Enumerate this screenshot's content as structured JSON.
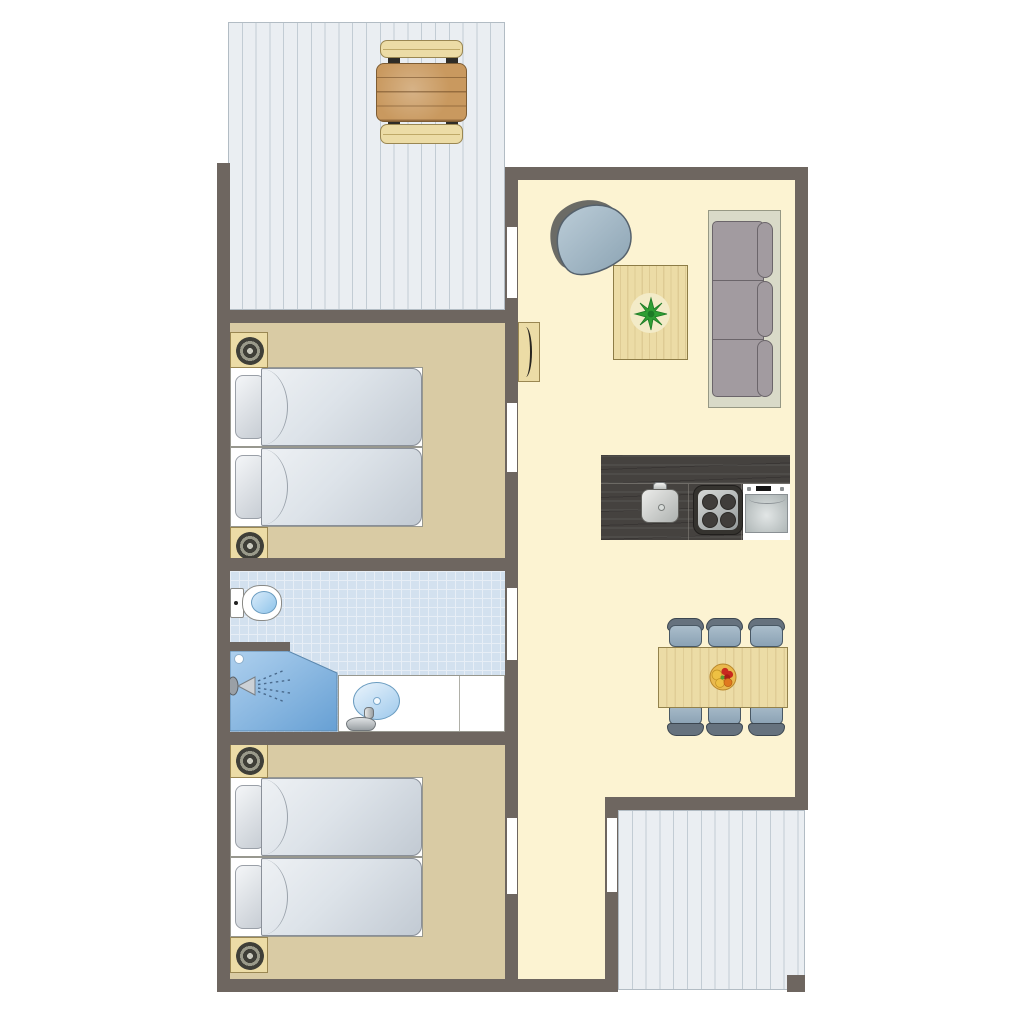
{
  "title": "holiday-cottage-floor-plan",
  "palette": {
    "wall": "#6e6660",
    "living_floor": "#fcf3d2",
    "bedroom_floor": "#d9cba4",
    "bathroom_floor": "#d3e1ef",
    "bathroom_grid": "#e7eef6",
    "deck": "#eaeef2",
    "deck_line": "#c2ccd4",
    "wood_light": "#ecdca6",
    "wood_border": "#9a8752",
    "wood_table": "#c9995f",
    "counter": "#45423f",
    "bed_duvet_light": "#eef1f4",
    "bed_duvet_dark": "#c2cad3",
    "sofa_frame": "#d9dac8",
    "sofa_cushion": "#a29ba0",
    "chair_seat": "#8ba2b4",
    "chair_back": "#66727e",
    "egg_chair": "#a7bac7",
    "shower_light": "#a9cdec",
    "shower_dark": "#6ea6d8",
    "sink_blue": "#9ec9ec",
    "plant": "#2f9e34",
    "fruit_red": "#c8291f",
    "fruit_yellow": "#eec043",
    "fruit_orange": "#e0791f",
    "lamp_dark": "#3f3f38",
    "lamp_ring": "#9a9a8a"
  },
  "areas": [
    {
      "id": "terrace-top",
      "furniture": [
        "picnic-bench",
        "picnic-table",
        "picnic-bench"
      ]
    },
    {
      "id": "bedroom-1",
      "furniture": [
        "nightstand-with-lamp",
        "single-bed",
        "single-bed",
        "nightstand-with-lamp"
      ]
    },
    {
      "id": "bathroom",
      "furniture": [
        "toilet",
        "shower",
        "washbasin-vanity"
      ]
    },
    {
      "id": "bedroom-2",
      "furniture": [
        "nightstand-with-lamp",
        "single-bed",
        "single-bed",
        "nightstand-with-lamp"
      ]
    },
    {
      "id": "living-room",
      "furniture": [
        "lounge-chair",
        "wall-tv",
        "coffee-table-with-plant",
        "three-seat-sofa"
      ]
    },
    {
      "id": "kitchen",
      "furniture": [
        "kitchen-sink",
        "hob-4-burners",
        "dishwasher"
      ]
    },
    {
      "id": "dining-corner",
      "furniture": [
        "dining-table",
        "chair",
        "chair",
        "chair",
        "chair",
        "chair",
        "chair",
        "fruit-bowl"
      ]
    },
    {
      "id": "hallway",
      "furniture": []
    },
    {
      "id": "terrace-bottom",
      "furniture": []
    }
  ],
  "door_openings": 5
}
